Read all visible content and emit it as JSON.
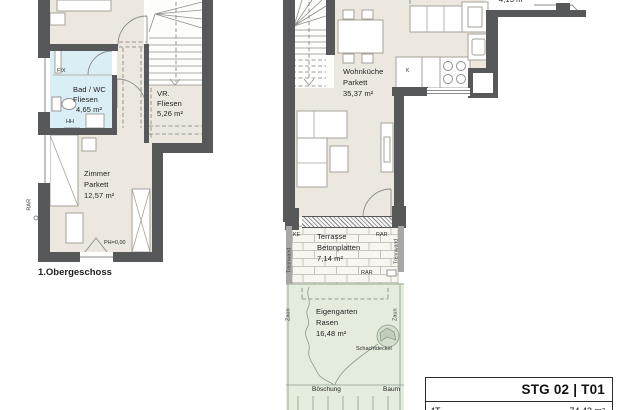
{
  "colors": {
    "wall": "#57585a",
    "floor_parquet": "#ece8df",
    "bath_tiles": "#daeef5",
    "garden_green": "#e3ecdd",
    "terrace": "#f8f6f1"
  },
  "left_plan": {
    "floor_label": "1.Obergeschoss",
    "rooms": {
      "bad": {
        "name": "Bad / WC",
        "surface": "Fliesen",
        "area": "4,65 m²"
      },
      "vr": {
        "name": "VR.",
        "surface": "Fliesen",
        "area": "5,26 m²"
      },
      "zimmer": {
        "name": "Zimmer",
        "surface": "Parkett",
        "area": "12,57 m²"
      }
    },
    "labels": {
      "fix": "FIX",
      "hh": "HH",
      "rar": "RAR",
      "ph": "PH=0,00"
    }
  },
  "right_plan": {
    "neighbor_area_clipped": "4,13 m²",
    "rooms": {
      "wohnkueche": {
        "name": "Wohnküche",
        "surface": "Parkett",
        "area": "35,37 m²"
      },
      "terrasse": {
        "name": "Terrasse",
        "surface": "Betonplatten",
        "area": "7,14 m²"
      },
      "eigengarten": {
        "name": "Eigengarten",
        "surface": "Rasen",
        "area": "16,48 m²"
      }
    },
    "labels": {
      "ke": "KE",
      "rar": "RAR",
      "trennwand": "Trennwand",
      "zaun": "Zaun",
      "schachtdeckel": "Schachtdeckel",
      "boeschung": "Böschung",
      "baum": "Baum",
      "kitchen_unit": "K"
    }
  },
  "title_block": {
    "unit": "STG 02 | T01",
    "row2_left": "4T",
    "row2_right": "74,43 m²"
  }
}
